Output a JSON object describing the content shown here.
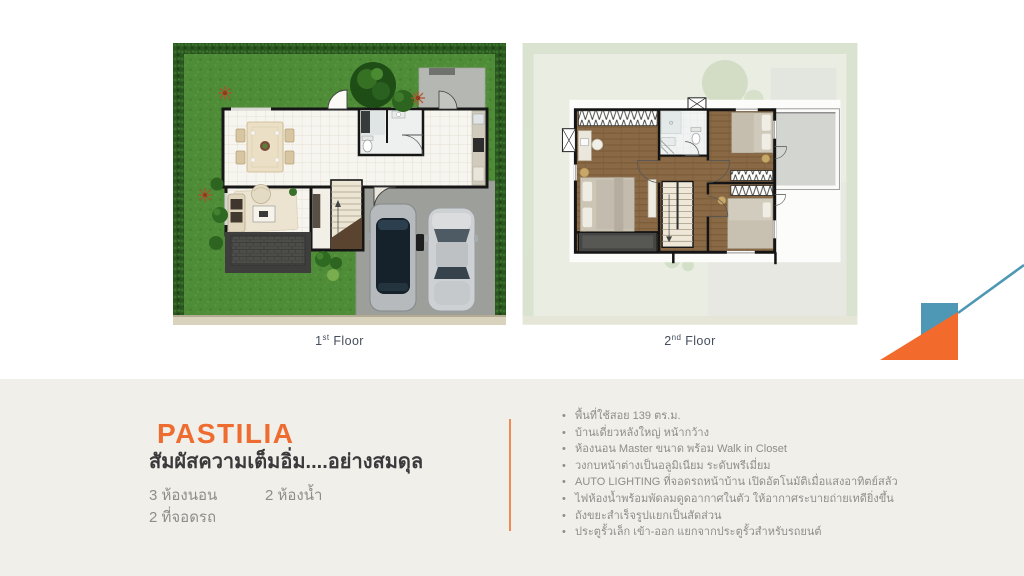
{
  "slide": {
    "floor_labels": {
      "first": {
        "number": "1",
        "ordinal": "st",
        "word": "Floor"
      },
      "second": {
        "number": "2",
        "ordinal": "nd",
        "word": "Floor"
      }
    },
    "product": {
      "name": "PASTILIA",
      "tagline": "สัมผัสความเต็มอิ่ม....อย่างสมดุล",
      "specs": {
        "bedrooms": "3 ห้องนอน",
        "bathrooms": "2 ห้องน้ำ",
        "parking": "2 ที่จอดรถ"
      },
      "features": [
        "พื้นที่ใช้สอย 139 ตร.ม.",
        "บ้านเดี่ยวหลังใหญ่ หน้ากว้าง",
        "ห้องนอน Master ขนาด พร้อม Walk in Closet",
        "วงกบหน้าต่างเป็นอลูมิเนียม ระดับพรีเมี่ยม",
        "AUTO LIGHTING ที่จอดรถหน้าบ้าน เปิดอัตโนมัติเมื่อแสงอาทิตย์สลัว",
        "ไฟห้องน้ำพร้อมพัดลมดูดอากาศในตัว ให้อากาศระบายถ่ายเทดียิ่งขึ้น",
        "ถังขยะสำเร็จรูปแยกเป็นสัดส่วน",
        "ประตูรั้วเล็ก เข้า-ออก แยกจากประตูรั้วสำหรับรถยนต์"
      ]
    },
    "colors": {
      "accent_orange": "#ef6c30",
      "accent_teal": "#4e97b5",
      "divider_orange": "#ef8a55",
      "panel_background": "#f1efe9",
      "text_dark": "#3a3a3c",
      "text_gray": "#8e8d89",
      "floor_label": "#454e5c",
      "lawn_green": "#4f8c37",
      "hedge_green": "#2a5620"
    }
  }
}
